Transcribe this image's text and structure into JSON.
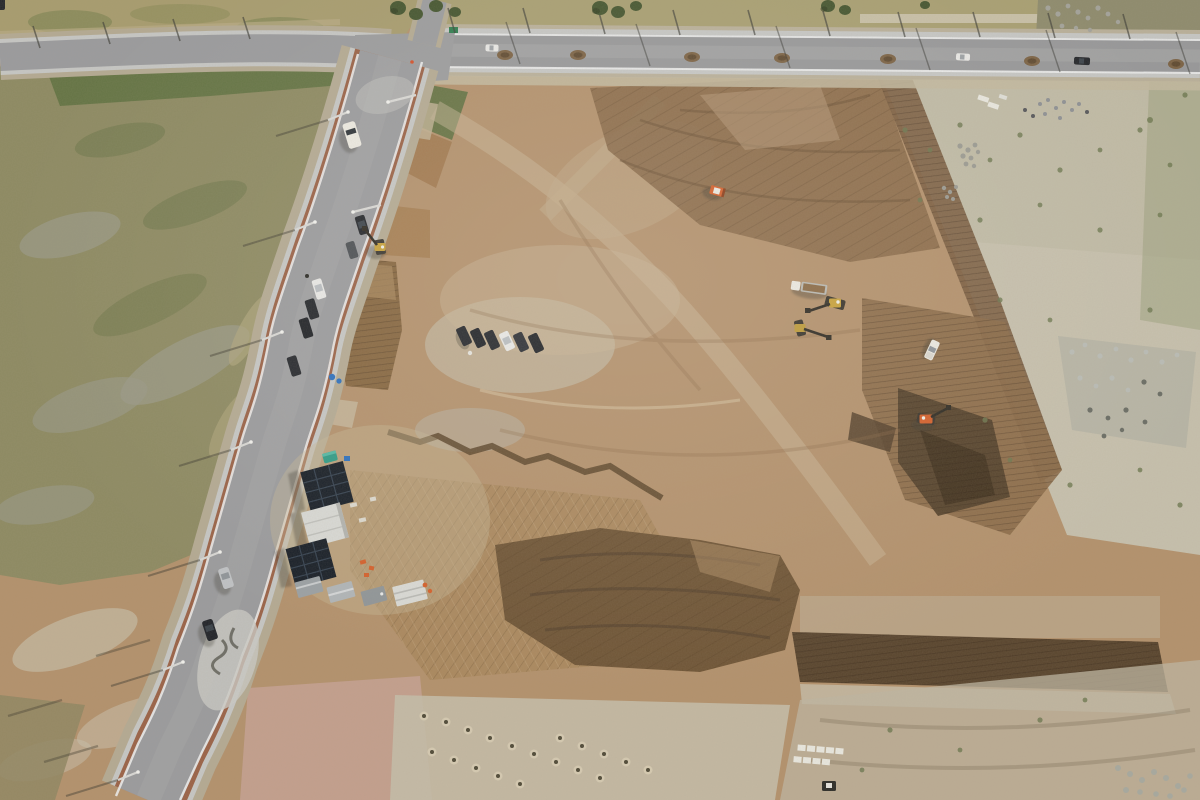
{
  "scene": {
    "type": "aerial-drone-photograph",
    "subject": "construction earthworks site bounded by a new side road and a main road",
    "regions": [
      "grass fields west of side road",
      "graded dirt construction pad",
      "pale scrub field east",
      "facility yard with solar arrays and containers"
    ]
  },
  "palette": {
    "dirt_base": "#b3916c",
    "dirt_light": "#c9b794",
    "dirt_pale": "#c4bca8",
    "dirt_dark": "#8a6a49",
    "dirt_darker": "#6e5435",
    "dirt_deep": "#53402a",
    "dirt_pink": "#c5a193",
    "spoil_brown": "#7a5d40",
    "grass_olive": "#8d8a62",
    "grass_upper": "#a79c6e",
    "green_dense": "#5d7040",
    "grass_gray": "#9a9a88",
    "scrub_pale": "#c6c0ad",
    "scrub_green": "#a8a887",
    "road_asphalt": "#9a9b9e",
    "road_concrete": "#c6c7c5",
    "road_shoulder": "#b4aa93",
    "curb_white": "#eceded",
    "curb_terracotta": "#9a6247",
    "solar_panel": "#161d26",
    "roof_white": "#d8d9d5",
    "container_gray": "#b0b5b8",
    "machine_yellow": "#c8a23a",
    "machine_orange": "#d45f2a",
    "truck_white": "#eceae2",
    "car_dark": "#23262b",
    "car_white": "#e9e9e7",
    "car_silver": "#c0c3c6",
    "rubble_gray": "#a7a99f",
    "block_white": "#e9e8e0",
    "tent_teal": "#2f9b86",
    "barrel_blue": "#2b6fbe",
    "sign_green": "#2e7d4f",
    "shadow": "#3c3a30"
  },
  "counts": {
    "excavators": 4,
    "bulldozers": 1,
    "dump_trucks": 1,
    "pickup_trucks": 1,
    "parked_cars_site_row": 6,
    "parked_cars_roadside": 5,
    "cars_on_side_road": 4,
    "vehicles_on_top_road": 3,
    "solar_panel_arrays": 2,
    "site_containers": 4,
    "concrete_blocks": 9,
    "soil_stockpiles_on_road": 7
  }
}
